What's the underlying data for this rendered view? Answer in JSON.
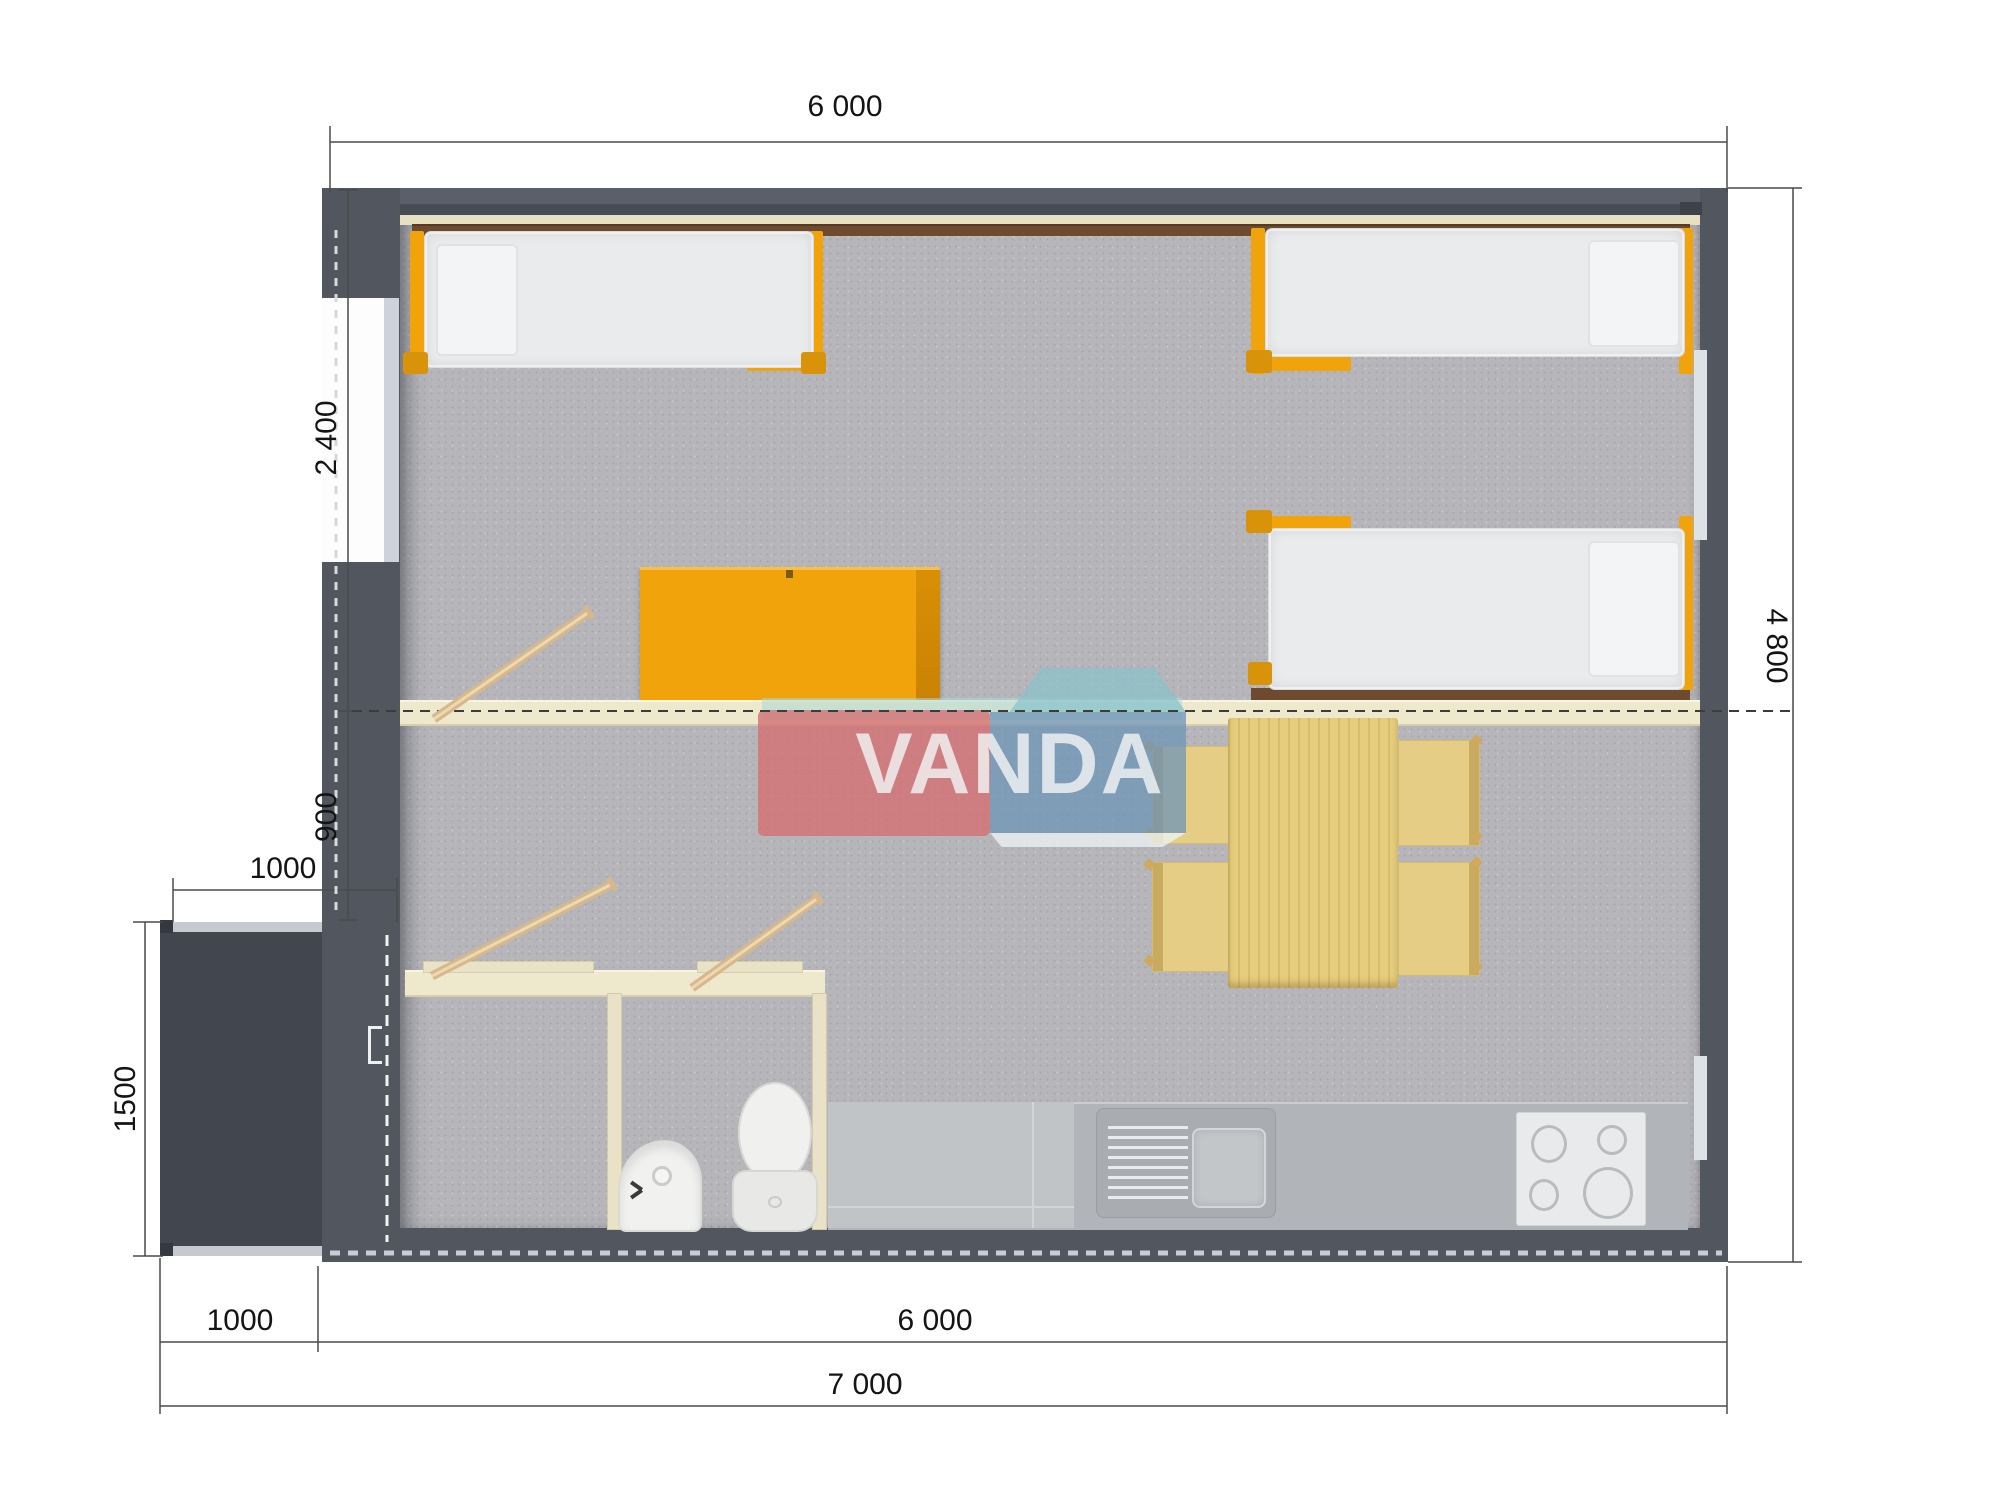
{
  "dims": {
    "top_width": "6 000",
    "bedroom_depth": "2 400",
    "loft_depth": "900",
    "porch_width_top": "1000",
    "porch_depth": "1500",
    "porch_width_bottom": "1000",
    "house_width_bottom": "6 000",
    "total_width_bottom": "7 000",
    "house_depth_right": "4 800"
  },
  "watermark": {
    "text": "VANDA"
  },
  "colors": {
    "wall": "#51565f",
    "porch": "#42474f",
    "carpet": "#b6b6ba",
    "accent_orange": "#f1a30c",
    "bed_mattress": "#e9ebec",
    "wood_table": "#e6cd7e",
    "partition_cream": "#eee8cd",
    "headboard_brown": "#6e4b2f",
    "counter_gray": "#b1b5b9",
    "logo_red": "#d46f73",
    "logo_blue": "#6d94b7",
    "logo_teal": "#a8d8d6"
  }
}
